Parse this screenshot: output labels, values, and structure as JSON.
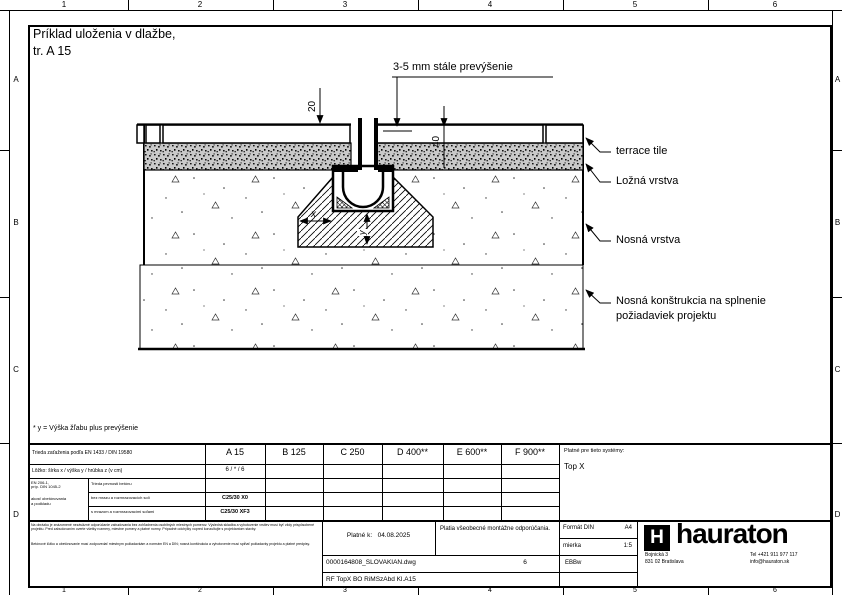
{
  "colors": {
    "ink": "#000000",
    "paper": "#ffffff",
    "bedding_gray": "#c9c9c9"
  },
  "sheet": {
    "title1": "Príklad uloženia v dlažbe,",
    "title2": "tr. A 15",
    "ruler": {
      "columns": [
        "1",
        "2",
        "3",
        "4",
        "5",
        "6"
      ],
      "rows": [
        "A",
        "B",
        "C",
        "D"
      ]
    }
  },
  "drawing": {
    "annotation_top": "3-5 mm stále prevýšenie",
    "dims": {
      "d20": "20",
      "d40": "40",
      "dx": "x",
      "dy": "y"
    },
    "labels": [
      "terrace tile",
      "Ložná vrstva",
      "Nosná vrstva",
      "Nosná konštrukcia na splnenie požiadaviek projektu"
    ]
  },
  "footnote": "* y = Výška žľabu plus prevýšenie",
  "table": {
    "load_class_row": {
      "label": "Trieda zaťaženia podľa EN 1433 / DIN 19580",
      "cells": [
        "A 15",
        "B 125",
        "C 250",
        "D 400**",
        "E 600**",
        "F 900**"
      ]
    },
    "bedding_row": {
      "label": "Lôžko: šírka x / výška y / hrúbka z (v cm)",
      "value": "6 / * / 6"
    },
    "concrete": {
      "standard_lines": [
        "EN 206-1,",
        "príp. DIN 1045-2",
        "akosť obetónovania",
        "a podkladu"
      ],
      "rows": [
        {
          "label": "Trieda pevnosti betónu",
          "value": ""
        },
        {
          "label": "bez mrazu a rozmrazovacích solí",
          "value": "C25/30 X0"
        },
        {
          "label": "s mrazom a rozmrazovacími soľami",
          "value": "C25/30 XF3"
        }
      ]
    },
    "systems": {
      "label": "Platné pre tieto systémy:",
      "value": "Top X"
    }
  },
  "titleblock": {
    "disclaimer_p1": "Na obrázku je znázornené nezáväzné odporúčanie zabudovania bez zohľadnenia osobitných miestnych pomerov. Výsledná skladba a vyhotovenie vrstiev musí byť vždy prispôsobené projektu. Pred zabudovaním overte všetky rozmery, miestne pomery a platné normy. Prípadné odchýlky vopred konzultujte s projektantom stavby.",
    "disclaimer_p2": "Betónové lôžko a obetónovanie musí zodpovedať miestnym požiadavkám a normám EN a DIN; nosná konštrukcia a vyhotovenie musí spĺňať požiadavky projektu a platné predpisy.",
    "valid_label": "Platné k:",
    "valid_date": "04.08.2025",
    "note": "Platia všeobecné montážne odporúčania.",
    "file_name": "0000164808_SLOVAKIAN.dwg",
    "sheet_no": "6",
    "doc_code": "RF TopX BO RiMSzAbd Kl.A15",
    "format_label": "Formát DIN",
    "format_value": "A4",
    "scale_label": "mierka",
    "scale_value": "1:5",
    "author": "EBBw",
    "logo_letter": "H",
    "brand": "hauraton",
    "address_line1": "Bojnická 3",
    "address_line2": "831 02 Bratislava",
    "phone": "Tel +421 911 977 117",
    "email": "info@hauraton.sk"
  }
}
